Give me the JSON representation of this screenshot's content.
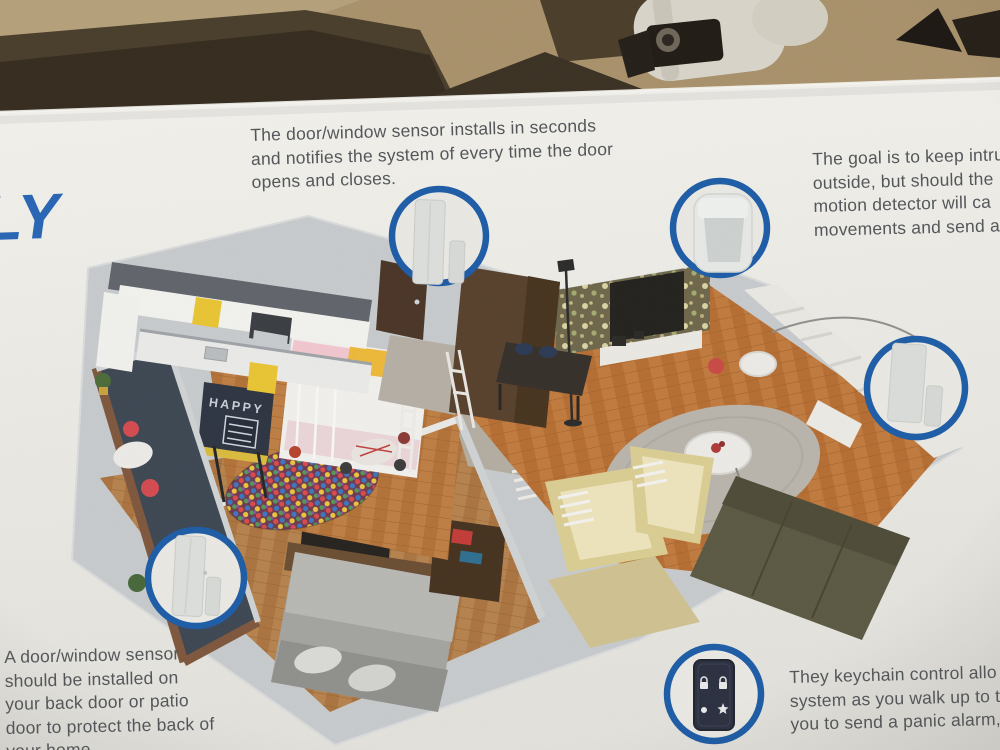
{
  "logo": {
    "text": "LY",
    "color": "#2b66b4"
  },
  "annotations": {
    "top": {
      "lines": [
        "The door/window sensor installs in seconds",
        "and notifies the system of every time the door",
        "opens and closes."
      ]
    },
    "right_clipped": {
      "lines": [
        "The goal is to keep intru",
        "outside, but should the",
        "motion detector will ca",
        "movements and send a"
      ]
    },
    "bottom_left": {
      "lines": [
        "A door/window sensor",
        "should be installed on",
        "your back door or patio",
        "door to protect the back of",
        "your home"
      ]
    },
    "bottom_right_clipped": {
      "lines": [
        "They keychain control allo",
        "system as you walk up to t",
        "you to send a panic alarm,"
      ]
    }
  },
  "floorplan": {
    "chalkboard_text": "HAPPY"
  },
  "callouts": [
    {
      "id": 1,
      "device": "door-window-sensor"
    },
    {
      "id": 2,
      "device": "motion-detector"
    },
    {
      "id": 3,
      "device": "door-window-sensor"
    },
    {
      "id": 4,
      "device": "door-window-sensor"
    },
    {
      "id": 5,
      "device": "keychain-remote"
    }
  ],
  "colors": {
    "accent_blue": "#1d5ca6",
    "logo_blue": "#2b66b4",
    "box_surface": "#eae9e4",
    "cardboard_tan": "#a8916b",
    "cardboard_shadow": "#453a29",
    "text_gray": "#54575a"
  }
}
